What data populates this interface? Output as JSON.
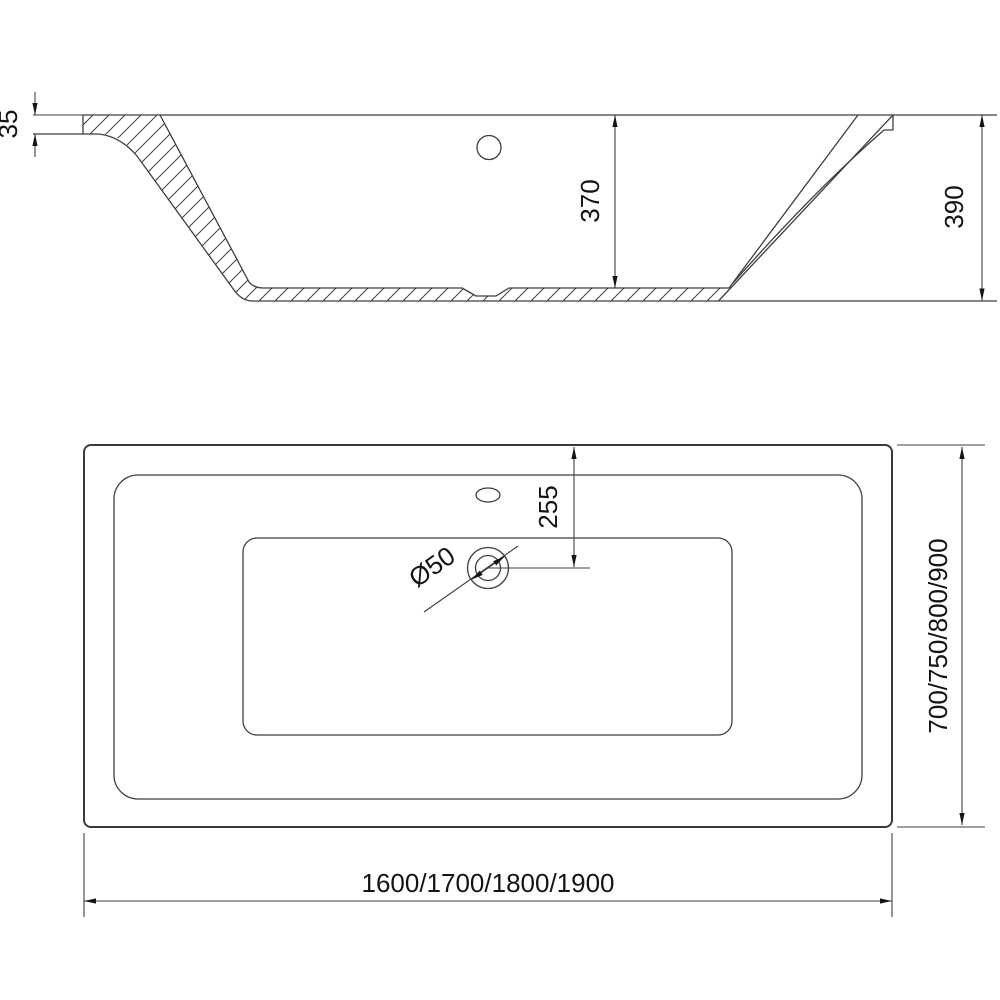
{
  "drawing": {
    "side_view": {
      "rim_thickness": "35",
      "inner_depth": "370",
      "overall_height": "390"
    },
    "plan_view": {
      "drain_offset": "255",
      "drain_diameter": "Ø50",
      "length_options": "1600/1700/1800/1900",
      "width_options": "700/750/800/900"
    },
    "colors": {
      "line": "#3f3f3f",
      "dimension_text": "#141414",
      "background": "#ffffff"
    }
  }
}
